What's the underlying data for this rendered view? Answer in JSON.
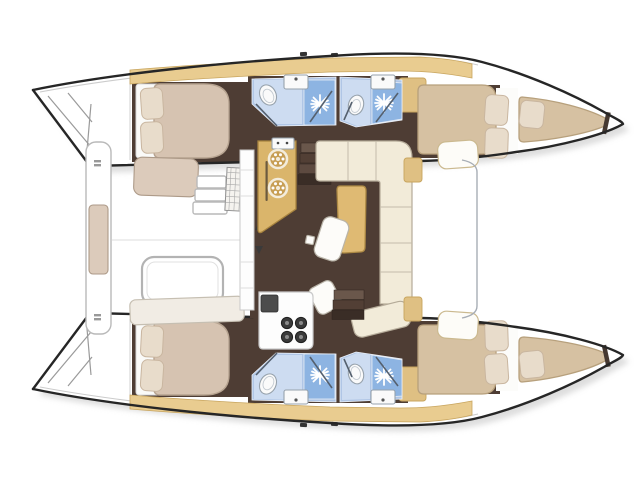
{
  "palette": {
    "background": "#ffffff",
    "hull_outline": "#262626",
    "toe_rail": "#cccccc",
    "shadow": "#bcbcbc",
    "floor_brown": "#4e3d34",
    "shelf_tan": "#e9cc90",
    "shelf_edge": "#c8a55e",
    "wardrobe_tan": "#dfc083",
    "head_floor_blue": "#b0c6e6",
    "head_panel_light": "#cddcf1",
    "head_shower_blue": "#8db4e2",
    "fixture_white": "#fafafa",
    "fixture_edge": "#97a2ac",
    "mattress_aft": "#d6c3b1",
    "mattress_fore": "#d6c1a2",
    "mattress_edge": "#b7a07c",
    "pillow": "#e8dccb",
    "pillow_edge": "#c9b6a0",
    "settee_cream": "#f2ebd9",
    "settee_edge": "#b5ab99",
    "table_tan": "#dfba73",
    "table_edge": "#ad8a45",
    "galley_tan": "#dab56b",
    "galley_edge": "#a8843f",
    "burner_ring": "#c79e54",
    "counter_white": "#fdfdfd",
    "counter_edge": "#c9c9c9",
    "appliance_dark": "#4c4c4c",
    "stove_burner": "#3a3a3a",
    "step_colors": [
      "#6a574b",
      "#523f35",
      "#5d4a40",
      "#3a2d26"
    ],
    "cushion_cockpit": "#dccbbb",
    "cushion_edge": "#ad9a88",
    "bench_white": "#ffffff",
    "bench_edge": "#b9b9b9",
    "foredeck_line": "#a7adb5",
    "door_line": "#55606e"
  },
  "vessel": {
    "view": "top-down-floor-plan",
    "type": "sailing-catamaran",
    "orientation": "bow-right-stern-left",
    "rooms": [
      "aft-cockpit-with-bench-and-table",
      "saloon-with-l-settee-and-table",
      "galley-with-double-round-sink",
      "galley-stove-four-burner",
      "port-aft-cabin-double-bed",
      "port-aft-head-with-shower",
      "port-forward-head-with-shower",
      "port-forward-cabin-double-bed",
      "port-forepeak-berth",
      "starboard-aft-cabin-double-bed",
      "starboard-aft-head-with-shower",
      "starboard-forward-head-with-shower",
      "starboard-forward-cabin-double-bed",
      "starboard-forepeak-berth",
      "foredeck-trampoline-area",
      "transom-steps-port",
      "transom-steps-starboard"
    ],
    "counts": {
      "cabins": 4,
      "heads": 4,
      "shower_stars": 4,
      "toilets": 4,
      "sinks_heads": 4
    }
  }
}
